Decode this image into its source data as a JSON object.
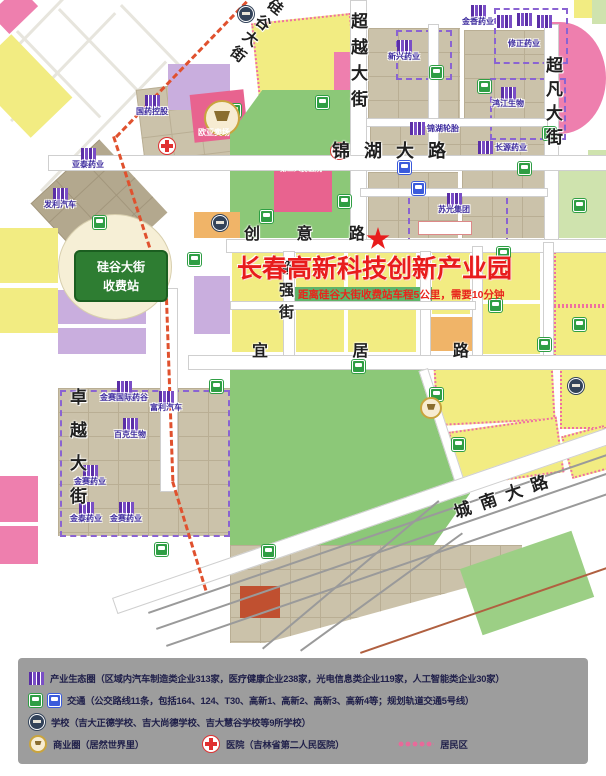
{
  "title": {
    "main": "长春高新科技创新产业园",
    "subtitle": "距离硅谷大街收费站车程5公里，需要10分钟"
  },
  "toll_badge": {
    "line1": "硅谷大街",
    "line2": "收费站"
  },
  "streets": {
    "guigu": "硅谷大街",
    "chaoyue": "超越大街",
    "chaofan": "超凡大街",
    "jinhu": "锦湖大路",
    "chuangyi": "创 意 路",
    "chaoqiang": "超强街",
    "yiju": "宜 居 路",
    "zhuoyue": "卓越大街",
    "chengnan": "城南大路"
  },
  "companies": [
    "国药控股",
    "亚泰药业",
    "发利汽车",
    "新兴药业",
    "金香药业",
    "修正药业",
    "鸿江生物",
    "锦湖轮胎",
    "长源药业",
    "苏光集团",
    "金赛国际药谷",
    "富利汽车",
    "百克生物",
    "金赛药业",
    "金泰药业",
    "金赛药业"
  ],
  "hospital_block_label": "第二人民医院",
  "mall_label": "欧亚卖场",
  "legend": {
    "items": [
      {
        "icon": "building-icon",
        "text": "产业生态圈（区域内汽车制造类企业313家，医疗健康企业238家，光电信息类企业119家，人工智能类企业30家）"
      },
      {
        "icon": "bus-icons",
        "text": "交通（公交路线11条，包括164、124、T30、高新1、高新2、高新3、高新4等；规划轨道交通5号线）"
      },
      {
        "icon": "school-icon",
        "text": "学校（吉大正德学校、吉大尚德学校、吉大慧谷学校等9所学校）"
      },
      {
        "icon": "mall-icon",
        "text": "商业圈（居然世界里）"
      },
      {
        "icon": "hospital-cross-icon",
        "text": "医院（吉林省第二人民医院）"
      },
      {
        "icon": "residential-dots",
        "text": "居民区"
      }
    ]
  },
  "colors": {
    "title_red": "#e81c1c",
    "toll_road_dash": "#e0512e",
    "park_green": "#8cc878",
    "residential_yellow": "#f2ec82",
    "industrial_tan": "#cbc2aa",
    "pink": "#ee7fae",
    "lavender": "#c9aede",
    "bus_green": "#2f9e44",
    "bus_blue": "#3b5bdb",
    "legend_bg": "#9d9d9d"
  }
}
